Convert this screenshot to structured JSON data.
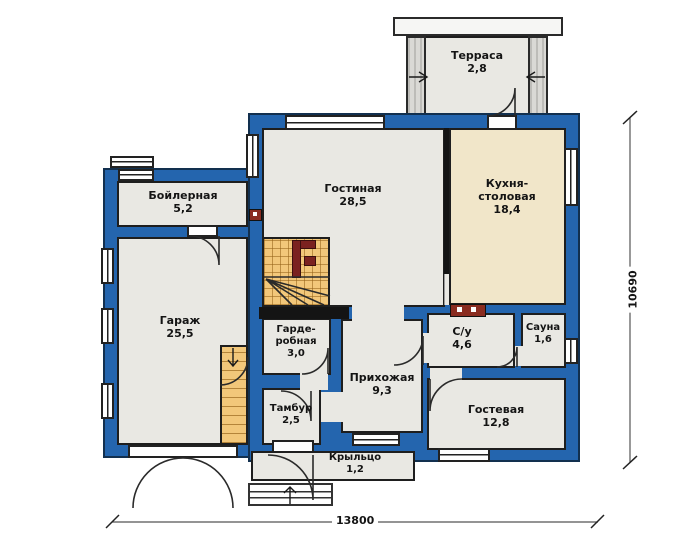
{
  "plan": {
    "title": "План первого этажа",
    "rooms": {
      "terrace": {
        "name": "Терраса",
        "area": "2,8"
      },
      "boiler": {
        "name": "Бойлерная",
        "area": "5,2"
      },
      "living": {
        "name": "Гостиная",
        "area": "28,5"
      },
      "kitchen": {
        "name": "Кухня-\nстоловая",
        "area": "18,4"
      },
      "garage": {
        "name": "Гараж",
        "area": "25,5"
      },
      "wardrobe": {
        "name": "Гарде-\nробная",
        "area": "3,0"
      },
      "hall": {
        "name": "Прихожая",
        "area": "9,3"
      },
      "bathroom": {
        "name": "С/у",
        "area": "4,6"
      },
      "sauna": {
        "name": "Сауна",
        "area": "1,6"
      },
      "vestibule": {
        "name": "Тамбур",
        "area": "2,5"
      },
      "guest": {
        "name": "Гостевая",
        "area": "12,8"
      },
      "porch": {
        "name": "Крыльцо",
        "area": "1,2"
      }
    },
    "dimensions": {
      "width_mm": "13800",
      "height_mm": "10690"
    },
    "colors": {
      "wall": "#2465ae",
      "wall_outline": "#12304f",
      "room_fill": "#e9e8e3",
      "kitchen_fill": "#f1e6c9",
      "stairs_fill": "#f2c77a",
      "railing": "#7b2220",
      "vent_block": "#8a2c20"
    }
  }
}
